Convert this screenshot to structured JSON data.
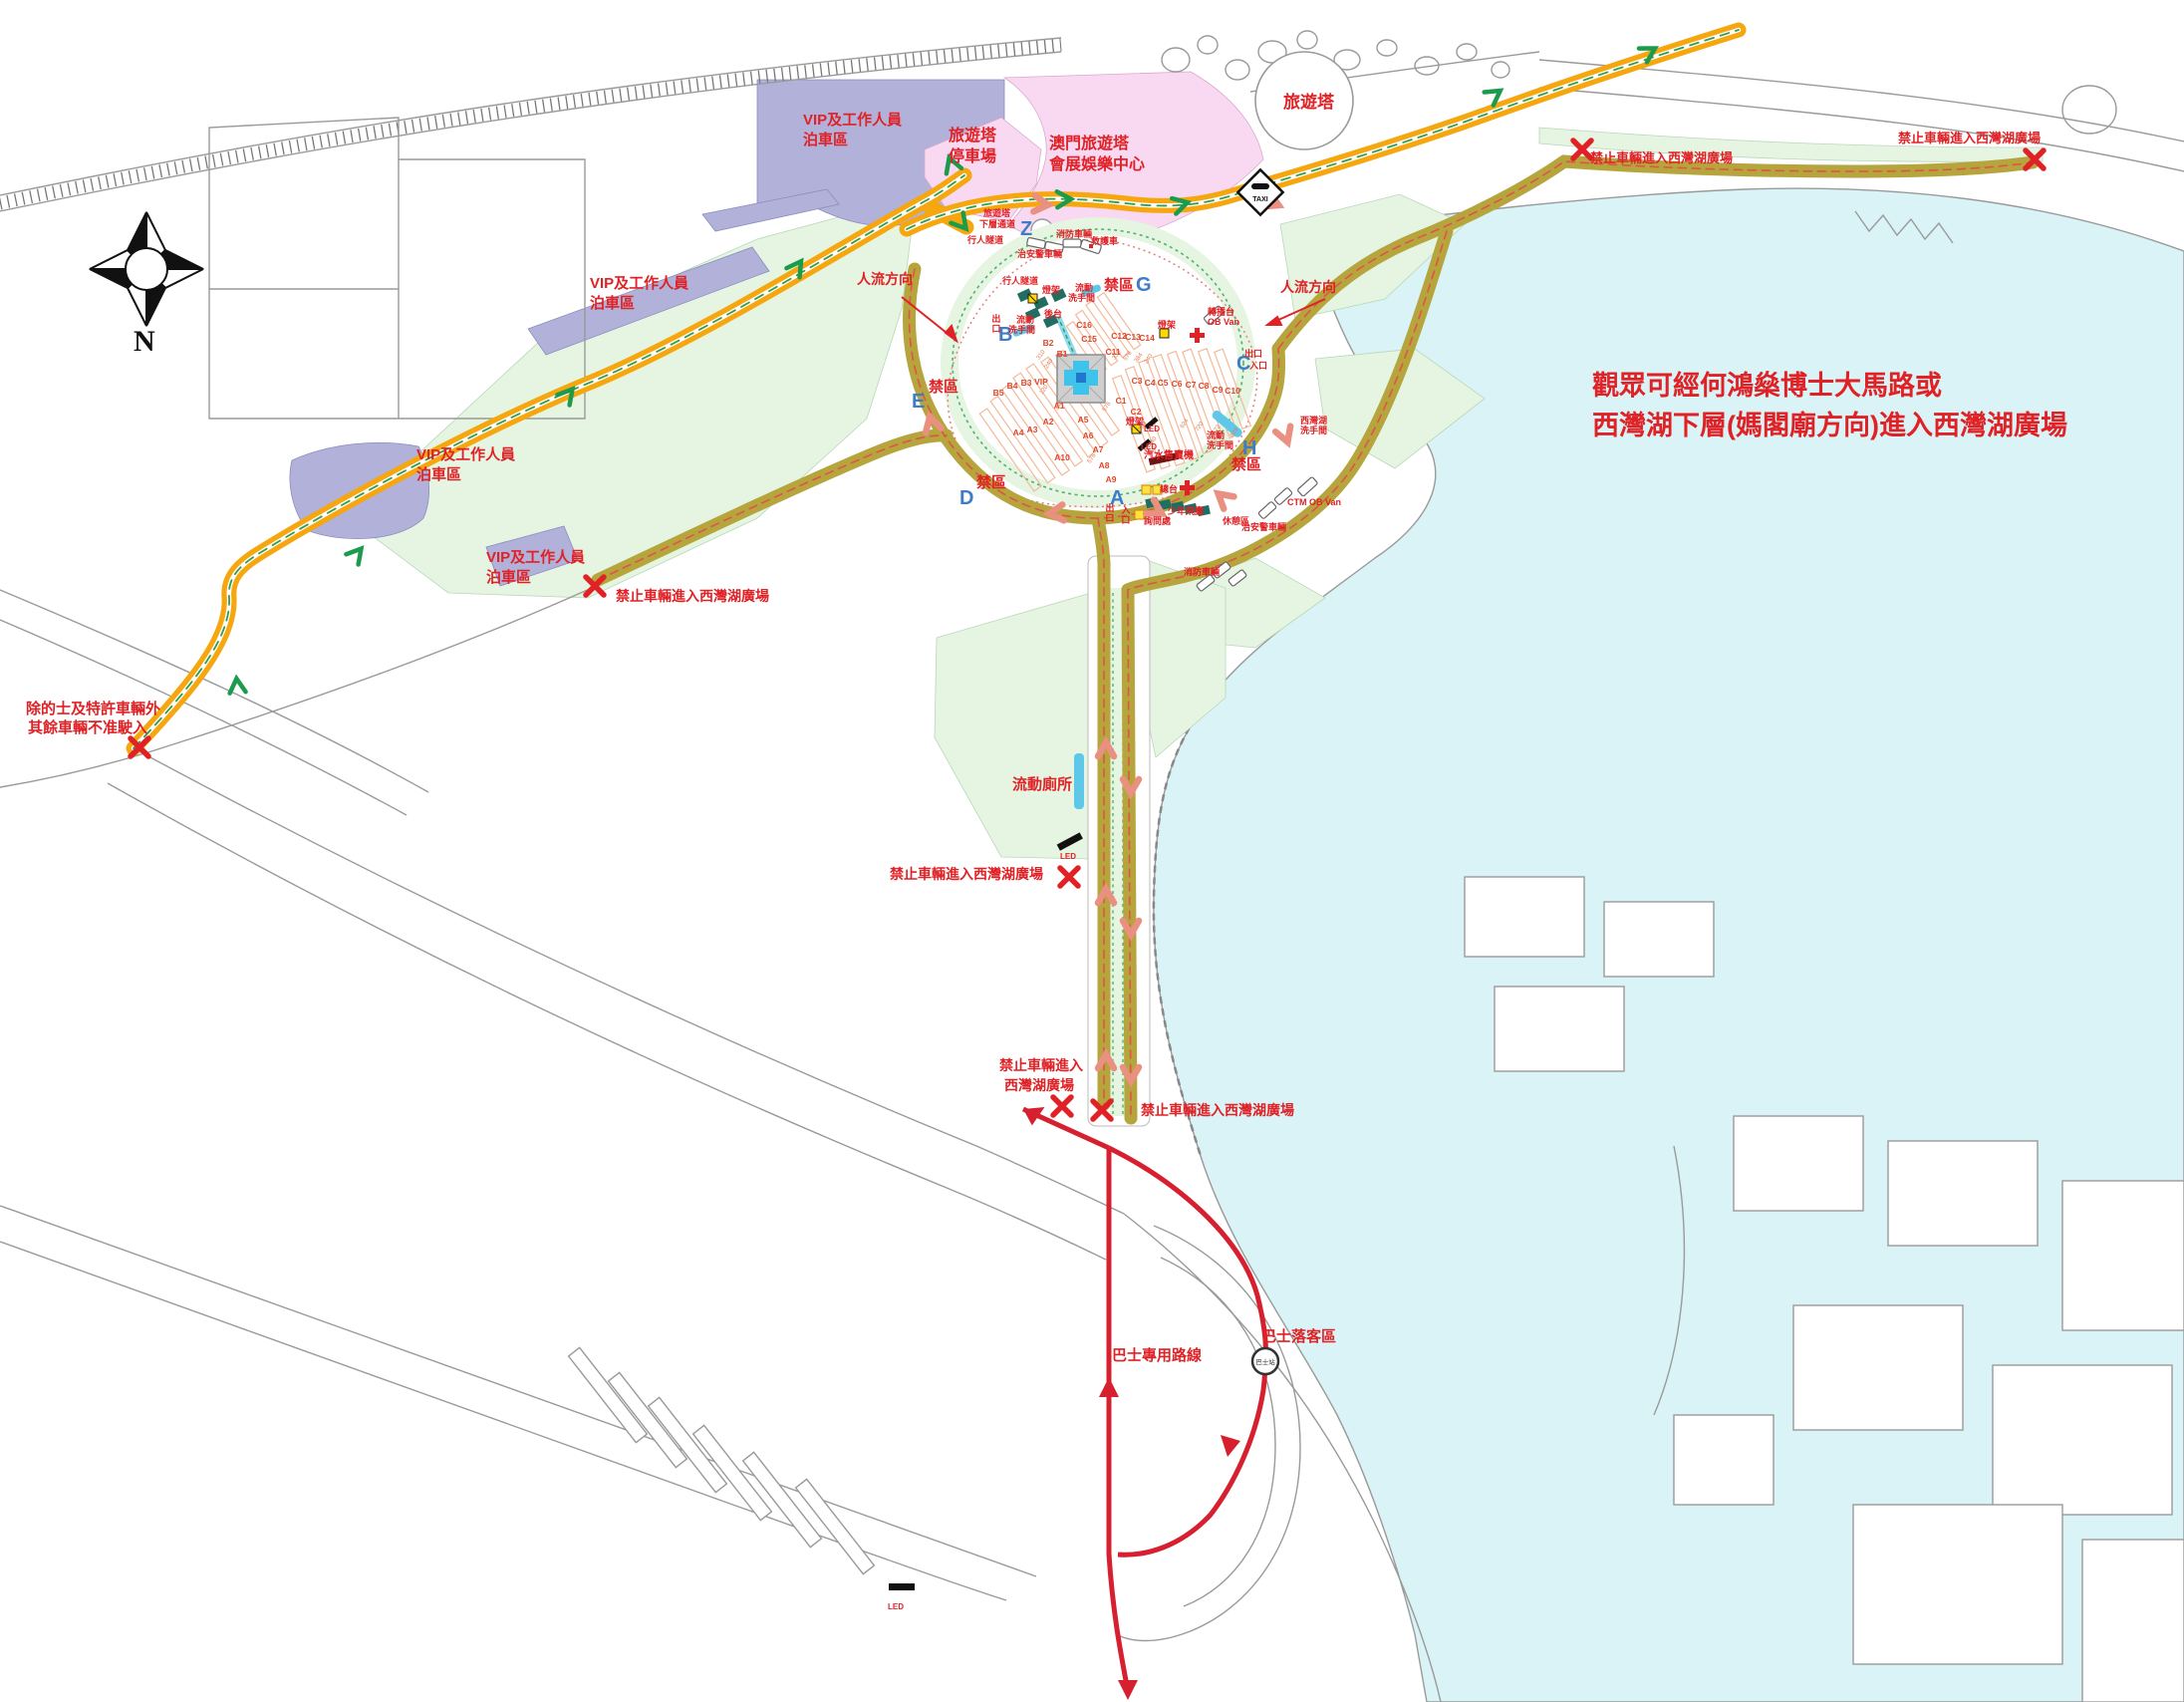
{
  "notice": {
    "line1": "觀眾可經何鴻燊博士大馬路或",
    "line2": "西灣湖下層(媽閣廟方向)進入西灣湖廣場"
  },
  "compass": {
    "north": "N"
  },
  "areas": {
    "tower": "旅遊塔",
    "convention_line1": "澳門旅遊塔",
    "convention_line2": "會展娛樂中心",
    "tower_carpark_line1": "旅遊塔",
    "tower_carpark_line2": "停車場",
    "vip_parking_line1": "VIP及工作人員",
    "vip_parking_line2": "泊車區"
  },
  "flow": {
    "label": "人流方向"
  },
  "restrictions": {
    "no_entry": "禁止車輛進入西灣湖廣場",
    "no_entry_line1": "禁止車輛進入",
    "no_entry_line2": "西灣湖廣場",
    "taxi_only_line1": "除的士及特許車輛外",
    "taxi_only_line2": "其餘車輛不准駛入"
  },
  "zones": {
    "restricted": "禁區",
    "a": "A",
    "b": "B",
    "c": "C",
    "d": "D",
    "e": "E",
    "g": "G",
    "h": "H",
    "z": "Z"
  },
  "facilities": {
    "tower_lower_line1": "旅遊塔",
    "tower_lower_line2": "下層通道",
    "pedestrian_tunnel": "行人隧道",
    "police_vehicles": "治安警車輛",
    "fire_vehicles": "消防車輛",
    "ambulance": "救護車",
    "mobile_toilet_line1": "流動",
    "mobile_toilet_line2": "洗手間",
    "portable_wc": "流動廁所",
    "lake_wc_line1": "西灣湖",
    "lake_wc_line2": "洗手間",
    "backstage": "後台",
    "light_rig": "燈架",
    "led": "LED",
    "vending": "汽水售賣機",
    "main_desk": "總台",
    "info_desk": "詢問處",
    "rest_area": "休憩區",
    "youth_eagles": "少年飛鷹",
    "ob_van_line1": "轉播台",
    "ob_van_line2": "OB Van",
    "ctm_ob_van": "CTM OB Van",
    "exit": "出口",
    "entrance": "入口",
    "taxi_stand": "TAXI",
    "bus_route": "巴士專用路線",
    "bus_dropoff": "巴士落客區",
    "bus_stop": "巴士站"
  },
  "seating": {
    "vip": "VIP",
    "a_sections": [
      "A1",
      "A2",
      "A3",
      "A4",
      "A5",
      "A6",
      "A7",
      "A8",
      "A9",
      "A10"
    ],
    "b_sections": [
      "B1",
      "B2",
      "B3",
      "B4",
      "B5"
    ],
    "c_sections": [
      "C1",
      "C2",
      "C3",
      "C4",
      "C5",
      "C6",
      "C7",
      "C8",
      "C9",
      "C10",
      "C11",
      "C12",
      "C13",
      "C14",
      "C15",
      "C16"
    ],
    "capacities": [
      "310",
      "240",
      "120",
      "360",
      "576",
      "336",
      "578",
      "384",
      "240",
      "288",
      "480",
      "624",
      "720",
      "672",
      "924",
      "576"
    ]
  },
  "colors": {
    "accent_red": "#e02125",
    "road_orange": "#f6a70f",
    "road_olive": "#b5a53c",
    "bus_red": "#d6202f",
    "water": "#d9f3f6",
    "park_green": "#e5f5e2",
    "vip_purple": "#b1b1d9",
    "venue_pink": "#f9d9f2",
    "zone_blue": "#3f7cc8"
  }
}
